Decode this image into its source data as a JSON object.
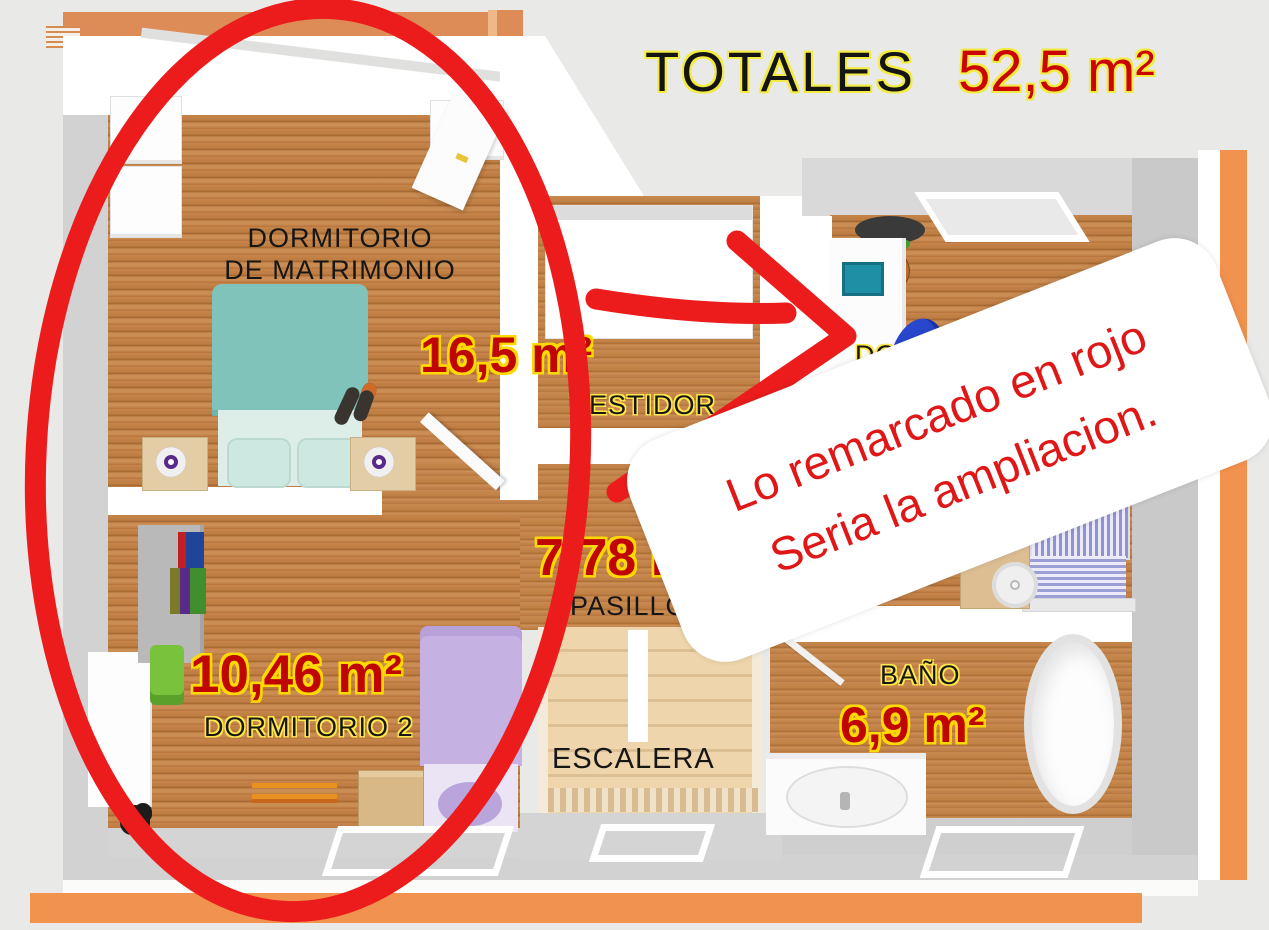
{
  "header": {
    "label": "TOTALES",
    "value": "52,5 m²"
  },
  "annotation": {
    "line1": "Lo remarcado en rojo",
    "line2": "Seria la ampliacion."
  },
  "rooms": {
    "master": {
      "name1": "DORMITORIO",
      "name2": "DE MATRIMONIO",
      "area": "16,5 m²"
    },
    "vestidor": {
      "name": "VESTIDOR"
    },
    "pasillo": {
      "name": "PASILLO",
      "area": "7,78 m²"
    },
    "escalera": {
      "name": "ESCALERA"
    },
    "dorm2": {
      "name": "DORMITORIO 2",
      "area": "10,46 m²"
    },
    "dorm_right": {
      "name": "DORMITORIO"
    },
    "bano": {
      "name": "BAÑO",
      "area": "6,9 m²"
    }
  },
  "colors": {
    "red_marker": "#ec1c1c",
    "annotation_text_red": "#e01717",
    "area_value_red": "#c00505",
    "outline_yellow": "#ffd900",
    "title_outline_yellow": "#f2ec42",
    "orange_trim": "#f2924f",
    "wood_floor": "#bd7c42",
    "stairs_wood": "#efd5ab",
    "teal_bed": "#7fc3bb",
    "purple_bed": "#c6b2e2",
    "striped_bed_blue": "#8f93cf",
    "background_gray": "#e9e9e7"
  }
}
